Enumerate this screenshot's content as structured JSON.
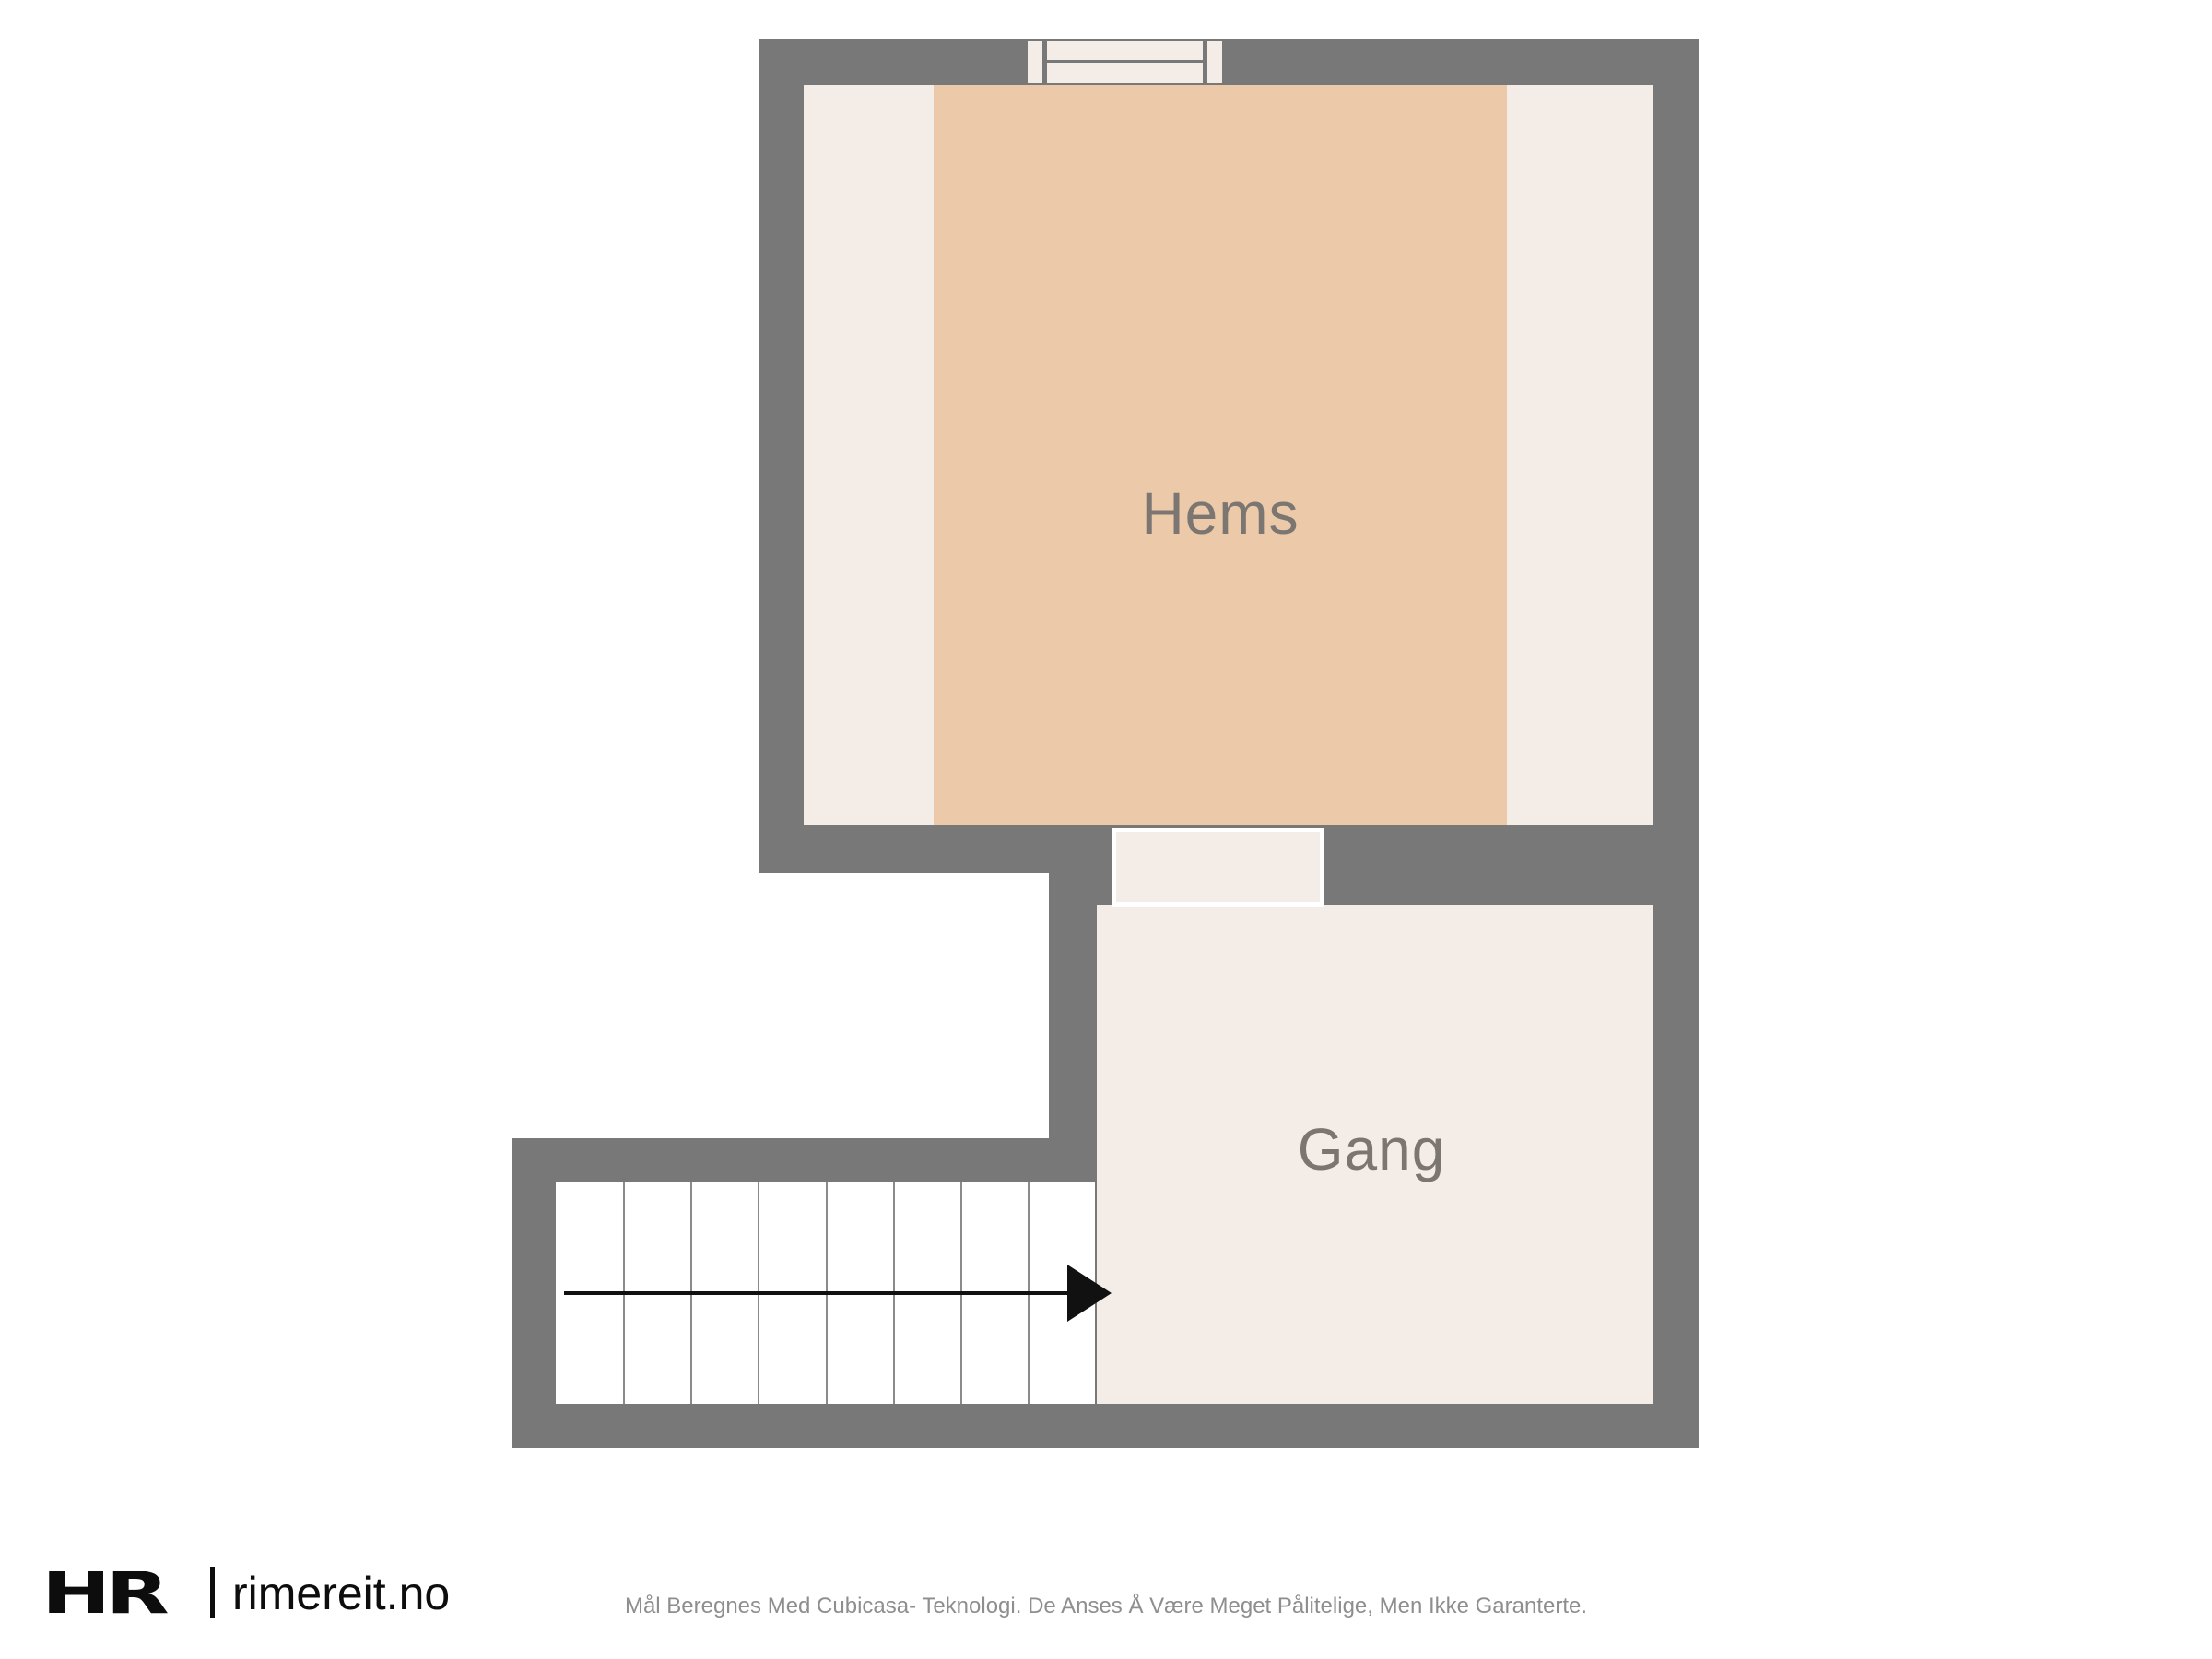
{
  "colors": {
    "page-bg": "#ffffff",
    "wall": "#787878",
    "room-fill": "#f4ede7",
    "accent-room-fill": "#ecc9a8",
    "stair-fill": "#ffffff",
    "stair-line": "#8a8a8a",
    "room-label": "#7b7671",
    "arrow": "#111111",
    "brand-text": "#0d0d0d",
    "disclaimer-text": "#8e8e8e"
  },
  "rooms": {
    "hems": {
      "label": "Hems"
    },
    "gang": {
      "label": "Gang"
    }
  },
  "staircase": {
    "steps": 8,
    "direction": "right"
  },
  "footer": {
    "brand": "HR",
    "site": "rimereit.no",
    "disclaimer": "Mål Beregnes Med Cubicasa- Teknologi. De Anses Å Være Meget Pålitelige, Men Ikke Garanterte."
  }
}
